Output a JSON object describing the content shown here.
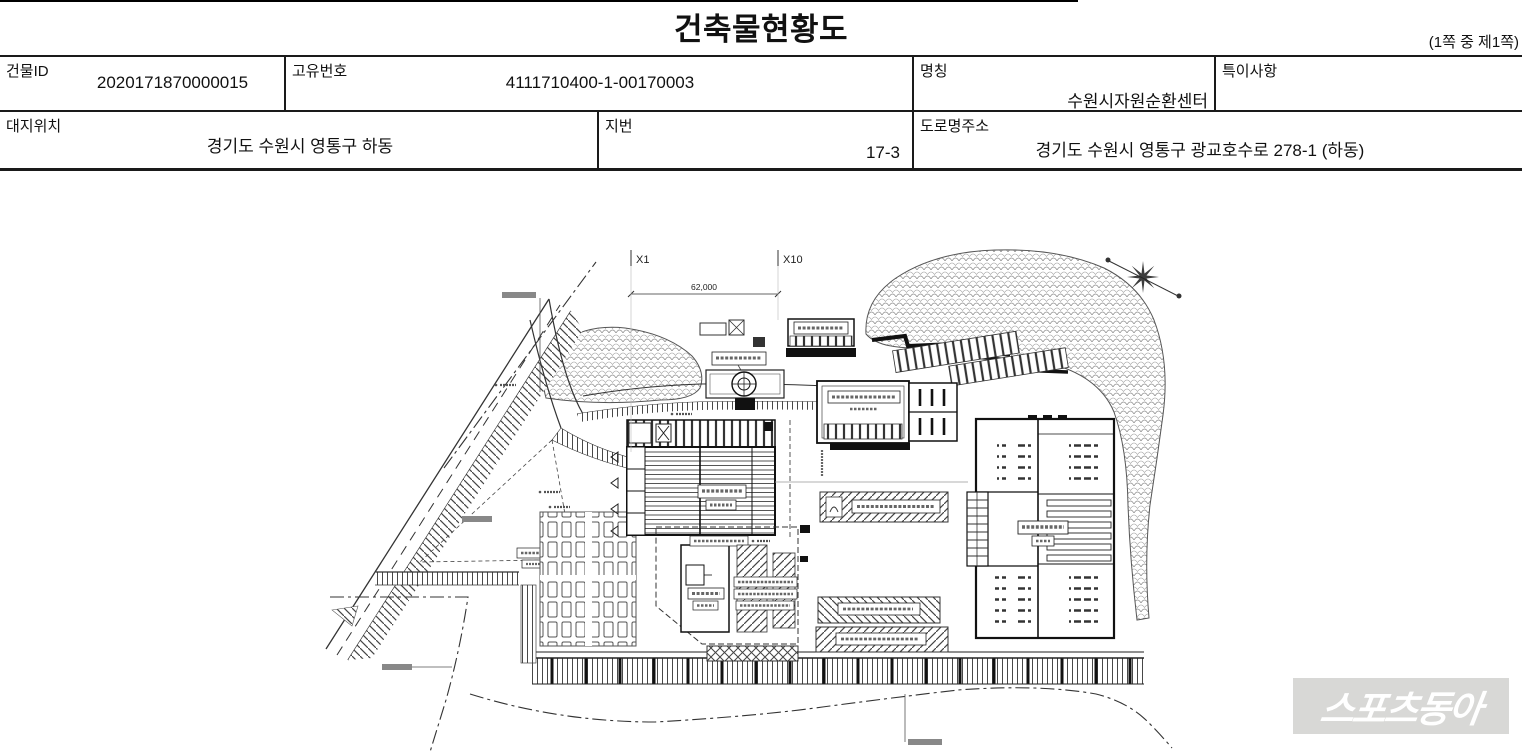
{
  "page": {
    "title": "건축물현황도",
    "page_note": "(1쪽 중 제1쪽)"
  },
  "info_table": {
    "rows": [
      {
        "cells": [
          {
            "label": "건물ID",
            "value": "2020171870000015"
          },
          {
            "label": "고유번호",
            "value": "4111710400-1-00170003"
          },
          {
            "label": "명칭",
            "value": "수원시자원순환센터"
          },
          {
            "label": "특이사항",
            "value": ""
          }
        ]
      },
      {
        "cells": [
          {
            "label": "대지위치",
            "value": "경기도 수원시 영통구 하동"
          },
          {
            "label": "지번",
            "value": "17-3"
          },
          {
            "label": "도로명주소",
            "value": "경기도 수원시 영통구 광교호수로 278-1 (하동)"
          }
        ]
      }
    ]
  },
  "site_plan": {
    "x1_label": "X1",
    "x10_label": "X10",
    "dimension": "62,000"
  },
  "watermark": {
    "text": "스포츠동아",
    "bg_color": "#d8d8d6",
    "text_color": "#ffffff"
  }
}
